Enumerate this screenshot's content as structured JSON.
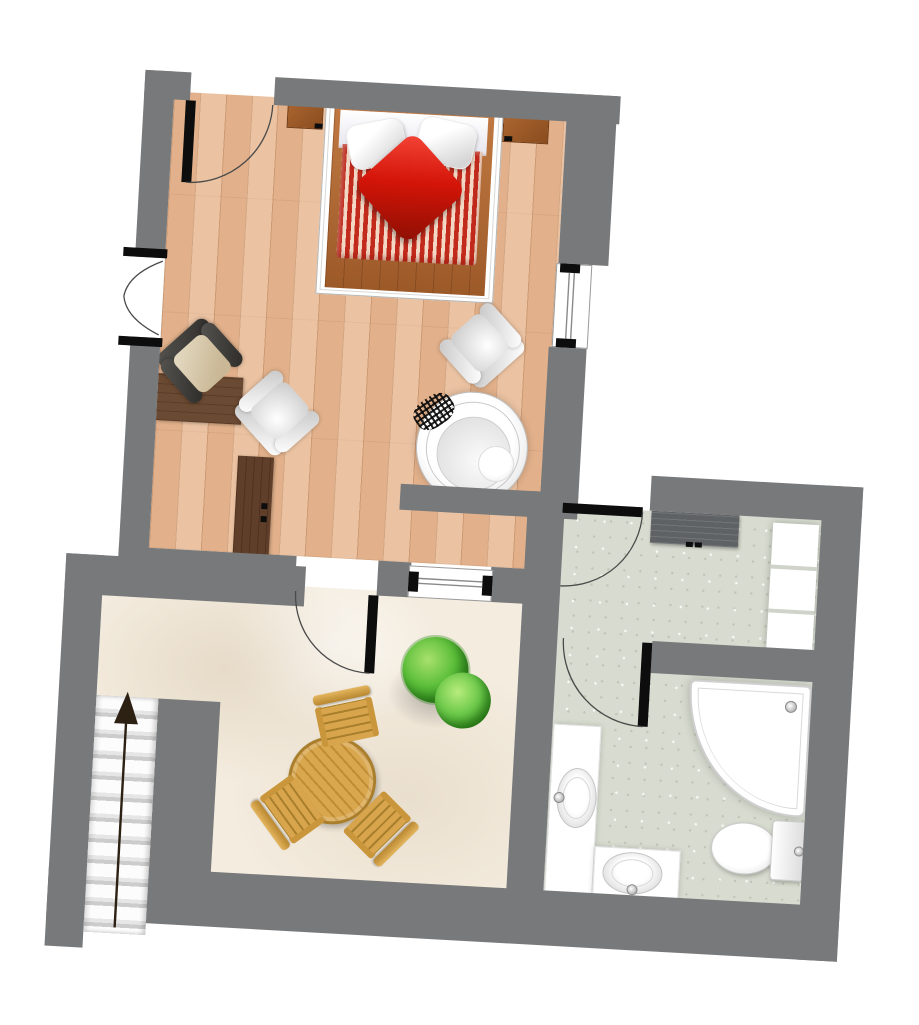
{
  "meta": {
    "type": "floor-plan",
    "description": "Apartment floor plan: bedroom with double bed and whirlpool, bathroom with corner shower, patio with table and staircase",
    "visible_text": "none",
    "rotation_deg": 3.2
  },
  "colors": {
    "wall": "#77797b",
    "wood_floor": "#e2b18b",
    "patio_floor": "#f4ecdf",
    "bath_floor": "#d8dcd0",
    "bed_deck_wood": "#b2662e",
    "duvet_red": "#c22a1c",
    "duvet_cream": "#f2d8c5",
    "cushion_red": "#d41408",
    "linen_white": "#ffffff",
    "nightstand_wood": "#a05e2e",
    "dark_desk_wood": "#6b4a33",
    "outdoor_wood": "#d9a74e",
    "plant_green": "#5cbf3a",
    "vanity_dark": "#5f6264",
    "arrow_dark": "#2d2114"
  },
  "rooms": {
    "bedroom": {
      "label": "Bedroom",
      "floor": "wood parquet",
      "furniture": [
        "double bed with red striped duvet",
        "white head sheet",
        "pillow",
        "pillow",
        "red cushion",
        "nightstand left",
        "nightstand right",
        "white armchair",
        "white armchair",
        "beige armchair with dark frame",
        "wall desk",
        "sideboard with 2 handles",
        "round whirlpool tub with step hatch"
      ]
    },
    "bathroom": {
      "label": "Bathroom",
      "floor": "speckled tile",
      "fixtures": [
        "dark vanity counter",
        "shelf unit with 3 bays",
        "corner shower",
        "toilet with cistern",
        "oval washbasin",
        "oval washbasin",
        "L-shaped white counter"
      ]
    },
    "patio": {
      "label": "Patio",
      "floor": "cream stone",
      "furniture": [
        "round slatted wooden table",
        "wooden chair",
        "wooden chair",
        "wooden chair",
        "plant with two bushes"
      ]
    }
  },
  "stairs": {
    "label": "Staircase",
    "steps": 11,
    "direction": "up",
    "icon": "up-arrow-icon"
  },
  "doors": [
    {
      "name": "bedroom-entry-door",
      "type": "swing"
    },
    {
      "name": "bedroom-to-patio-door",
      "type": "swing"
    },
    {
      "name": "bathroom-entry-door",
      "type": "swing"
    },
    {
      "name": "shower-room-door",
      "type": "swing"
    }
  ],
  "windows": [
    {
      "name": "bedroom-french-window-left"
    },
    {
      "name": "bedroom-window-right"
    },
    {
      "name": "patio-window"
    }
  ]
}
